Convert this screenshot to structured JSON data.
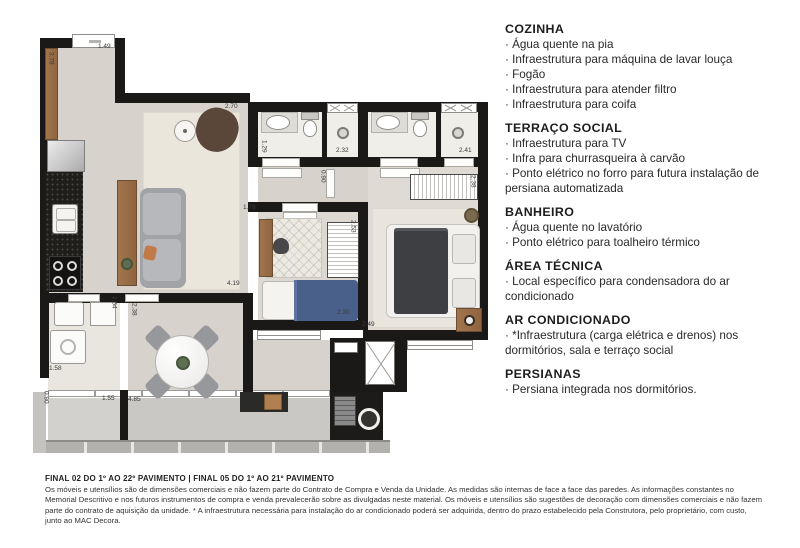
{
  "plan": {
    "dimensions": [
      {
        "value": "1.49",
        "x": 98,
        "y": 44,
        "vertical": false
      },
      {
        "value": "3.78",
        "x": 47,
        "y": 52,
        "vertical": true
      },
      {
        "value": "2.70",
        "x": 225,
        "y": 104,
        "vertical": false
      },
      {
        "value": "1.29",
        "x": 260,
        "y": 140,
        "vertical": true
      },
      {
        "value": "2.32",
        "x": 336,
        "y": 148,
        "vertical": false
      },
      {
        "value": "2.41",
        "x": 459,
        "y": 148,
        "vertical": false
      },
      {
        "value": "0.90",
        "x": 319,
        "y": 170,
        "vertical": true
      },
      {
        "value": "2.38",
        "x": 469,
        "y": 175,
        "vertical": true
      },
      {
        "value": "1.78",
        "x": 243,
        "y": 205,
        "vertical": false
      },
      {
        "value": "2.53",
        "x": 349,
        "y": 220,
        "vertical": true
      },
      {
        "value": "4.19",
        "x": 227,
        "y": 281,
        "vertical": false
      },
      {
        "value": "1.54",
        "x": 110,
        "y": 296,
        "vertical": true
      },
      {
        "value": "2.38",
        "x": 130,
        "y": 303,
        "vertical": true
      },
      {
        "value": "2.30",
        "x": 337,
        "y": 310,
        "vertical": false
      },
      {
        "value": "2.49",
        "x": 362,
        "y": 322,
        "vertical": false
      },
      {
        "value": "1.58",
        "x": 49,
        "y": 366,
        "vertical": false
      },
      {
        "value": "0.90",
        "x": 42,
        "y": 391,
        "vertical": true
      },
      {
        "value": "1.55",
        "x": 102,
        "y": 396,
        "vertical": false
      },
      {
        "value": "4.85",
        "x": 128,
        "y": 397,
        "vertical": false
      }
    ],
    "colors": {
      "wall": "#1b1917",
      "wood": "#9b6f4a",
      "counter": "#201e1b",
      "sofa": "#a2a3a6",
      "armchair": "#5b463a",
      "bed_blue": "#49608a",
      "duvet_dark": "#3e3f42",
      "terrace": "#cac8c4",
      "railing": "#b3b1ad",
      "rug": "#eae6dc"
    }
  },
  "specs": {
    "bullet": "·",
    "sections": [
      {
        "title": "COZINHA",
        "items": [
          "Água quente na pia",
          "Infraestrutura para máquina de lavar louça",
          "Fogão",
          "Infraestrutura para atender filtro",
          "Infraestrutura para coifa"
        ]
      },
      {
        "title": "TERRAÇO SOCIAL",
        "items": [
          "Infraestrutura para TV",
          "Infra para churrasqueira à carvão",
          "Ponto elétrico no forro para futura instalação de persiana automatizada"
        ]
      },
      {
        "title": "BANHEIRO",
        "items": [
          "Água quente no lavatório",
          "Ponto elétrico para toalheiro térmico"
        ]
      },
      {
        "title": "ÁREA TÉCNICA",
        "items": [
          "Local específico para condensadora do ar condicionado"
        ]
      },
      {
        "title": "AR CONDICIONADO",
        "items": [
          "*Infraestrutura (carga elétrica e drenos) nos dormitórios, sala e terraço social"
        ]
      },
      {
        "title": "PERSIANAS",
        "items": [
          "Persiana integrada nos dormitórios."
        ]
      }
    ]
  },
  "footer": {
    "title": "FINAL 02 DO 1º AO 22º PAVIMENTO | FINAL 05 DO 1º AO 21º PAVIMENTO",
    "body": "Os móveis e utensílios são de dimensões comerciais e não fazem parte do Contrato de Compra e Venda da Unidade. As medidas são internas de face a face das paredes. As informações constantes no Memorial Descritivo e nos futuros instrumentos de compra e venda prevalecerão sobre as divulgadas neste material. Os móveis e utensílios são sugestões de decoração com dimensões comerciais e não fazem parte do contrato de aquisição da unidade. * A infraestrutura necessária para instalação do ar condicionado poderá ser adquirida, dentro do prazo estabelecido pela Construtora, pelo proprietário, com custo, junto ao MAC Decora."
  }
}
